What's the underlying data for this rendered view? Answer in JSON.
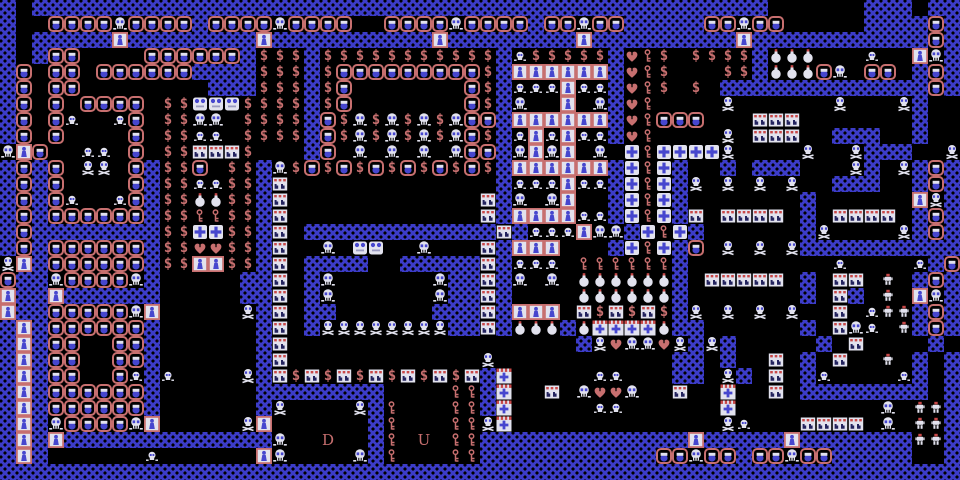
{
  "screen": {
    "width": 960,
    "height": 480
  },
  "palette": {
    "wall_blue": "#3c3cc8",
    "floor_black": "#000000",
    "salmon_pink": "#c76f6f",
    "sprite_white": "#e2e2ee",
    "sprite_blue": "#4646ce",
    "accent_red": "#c84848",
    "dark_navy": "#23235e"
  },
  "stairs": {
    "down_label": "D",
    "up_label": "U"
  },
  "glyphs": {
    "money": "$"
  },
  "legend": {
    "#": "wall-tile",
    ".": "floor-tile",
    "m": "monster-face",
    "S": "skull",
    "B": "skull-crossbones",
    "s": "small-skull",
    "W": "white-blob-monster",
    "$": "treasure-money",
    "h": "heart-food",
    "k": "key-item",
    "d": "locked-door",
    "c": "cross-tile",
    "X": "striped-cross-tile",
    "p": "potion-bomb",
    "r": "studded-tile",
    "w": "red-capped-skeleton",
    "D": "stairs-down",
    "U": "stairs-up"
  },
  "map": {
    "cols": 60,
    "rows": 30,
    "tile_size": 16,
    "grid": [
      "#.##############################################......###.##",
      "#..mmmmSmmmm#mmmmSmmmm..mmmmSmmmm#mmSmm#####mmSmm.....####m#",
      "#.#####d########d##########d########d#########d###########m#",
      "#.#mm....mmmmmm#$$$#$$$$$$$$$$$#s$$$$$#hk$.$$$$#ppp...s..dS#",
      "#m.mm.mmmmmm####$$$#$mmmmmmmmm$#dddddd#hk$...$$#pppmS.mm.#m#",
      "#m.mm........###$$$#$m.......m$#sssdss#hk$.$.#############m#",
      "#m.m.mmmm.$$WWW$$$$#$m.......m$#S..d.S#hk....B......B...B#..",
      "#m.ms..sm.$$SS.$$$$#m$S$S$S$Smm#dddddd#hkmmm...rrr.......#..",
      "#m.m....m.$$ss.$$$$#m$S$S$S$Sm$#sdsdss#hk....B.rrr..###..#..",
      "Sdm..ss.m.$$rrr$...#m.S.S.S.Smm#SdSd.S.ckccccB....B..B###..B",
      "#m#m.BB.m#$$m.$$#S$m$m$m$m$m$m$#dddddd#ckc#..#.###...B#.B#m#",
      "#m#m....m#$$ss$$#r.............#sssdss#ckc#B.B.B.B..###..#m#",
      "#m#ms..sm#$$pp$$#r............r#S.Sd..#ckc#.......#......dB#",
      "#m#mmmmmm#$$kk$$#r............r#ddddss#ckc#r.rrrr.#.rrrr.#m#",
      "#m########$$cc$$#r.############r#sssdSS#ckc#......#B....B#m#",
      "#m#mmmmmm#$$hh$$#r..S.WW..S...r#ddd...#ckc#m.B.B.B##########",
      "Bd#mmmmmm#$$dd$$#r.####..#####r#sss.kkkkkk#.........s....s#m#",
      "m##SmmmmS#.....##r.#S......S##r#S.S.pppppp#.rrrrr.#.rr.w.#m#",
      "d##d######.....##r.#S......S##r#....pppppp#.......#.r#.w.dS#",
      "d##mmmmmSd.....B#r.##......###r#ddd.r$r$r$#B.B.B.B..r.sww#m#",
      "#d#mmmmmm#......#r.#BBBBBBBB##r#ppp#pXXXXp##......#.rSs.w#m#",
      "#d#mm..mm#......#r..................#BhSShB#B#.....#.r....#.#",
      "#d#mm..mm#......#r............B...........##.#..r.#.r..w.#.#",
      "#d#mm..ms#s....B#r$r$r$r$r$r$r#X.....ss...##.B#.r.#s....s#.#",
      "#d#mmmmmm#......########....kk#X..r.ShhS..r..X..r.########.#",
      "#d#mmmmmm#......#B....B#k...kk#X.....ss......X.........S.ww#",
      "#d#SmmmmSd.....Bd......#k...kkBX.............Bs...rrrr.S.ww#",
      "#d#d#############S..D..#k.U.kk#############d#####d#######ww#",
      "#d#......s......dS....S#k...kk###########mmSmm#mmSmm#####..#",
      "############################################################"
    ]
  }
}
